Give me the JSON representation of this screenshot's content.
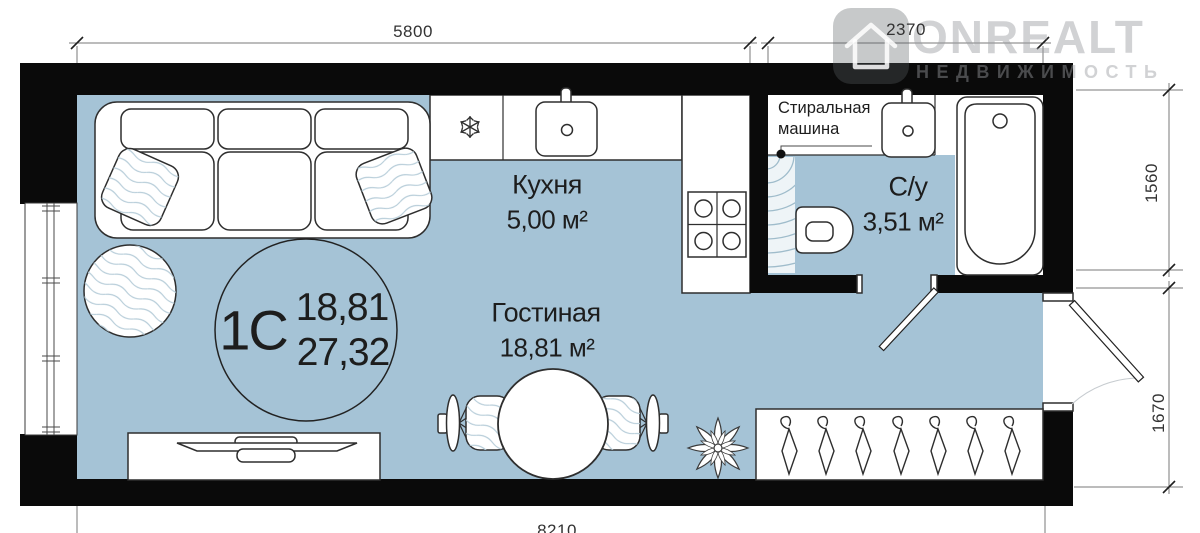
{
  "unit": {
    "type_label": "1С",
    "living_area": "18,81",
    "total_area": "27,32"
  },
  "rooms": {
    "kitchen": {
      "name": "Кухня",
      "area": "5,00 м²"
    },
    "living": {
      "name": "Гостиная",
      "area": "18,81 м²"
    },
    "bathroom": {
      "name": "С/у",
      "area": "3,51 м²"
    }
  },
  "appliances": {
    "washer_label_line1": "Стиральная",
    "washer_label_line2": "машина"
  },
  "dimensions": {
    "top_left": "5800",
    "top_right": "2370",
    "right_upper": "1560",
    "right_lower": "1670",
    "bottom": "8210"
  },
  "watermark": {
    "brand": "ONREALT",
    "tagline": "НЕДВИЖИМОСТЬ"
  },
  "icons": {
    "snowflake-icon": "fridge freezer marker",
    "hanger-icon": "wardrobe hanger (7x)",
    "house-icon": "watermark logo house"
  },
  "colors": {
    "floor": "#a5c3d6",
    "wall": "#0a0a0a",
    "pat": "#b7cdd9",
    "ink": "#2e2e2e",
    "dim": "#787878",
    "wm": "rgba(152,156,159,0.45)"
  }
}
